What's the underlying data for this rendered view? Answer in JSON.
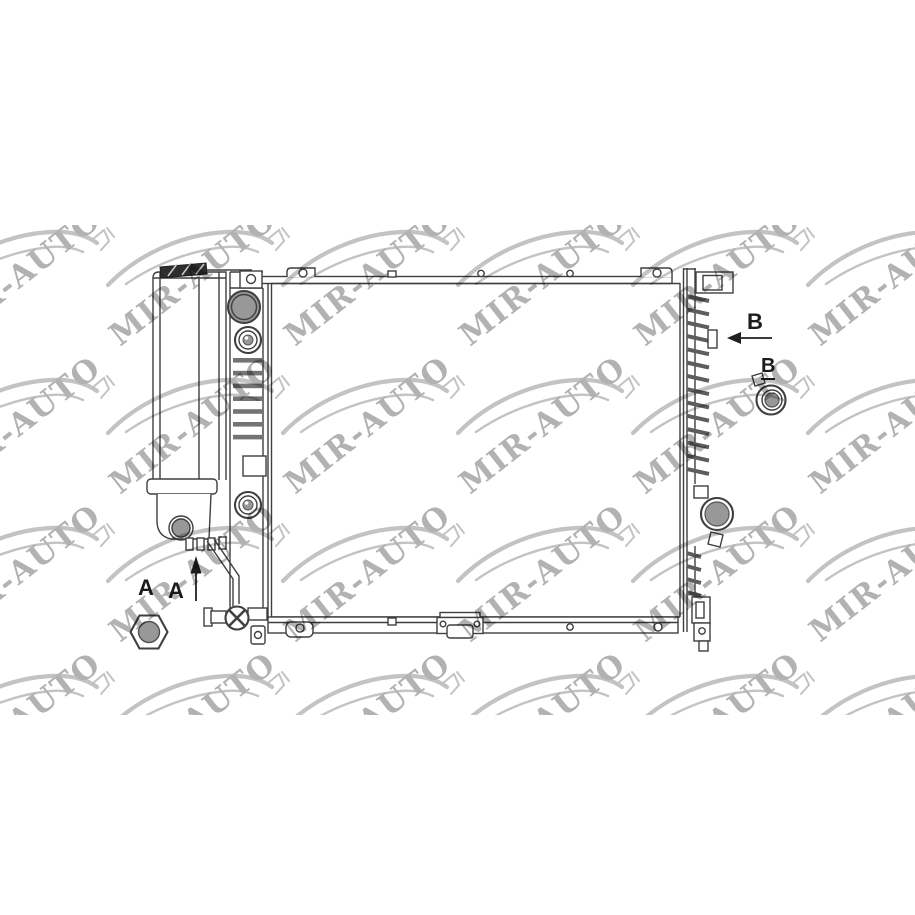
{
  "page": {
    "width": 915,
    "height": 915,
    "background_color": "#ffffff"
  },
  "product_image": {
    "description": "Technical line drawing of an automotive radiator, front view, with left expansion tank, filler cap, drain valves, core, side channel with hose port, mounting grommet, hex nut and phillips screw",
    "style": {
      "line_color": "#3f3f3f",
      "metal_fill": "#989898",
      "dark_fill": "#2e2e2e"
    }
  },
  "watermark": {
    "text": "MIR-AUTO",
    "text_color": "#b2b2b2",
    "swoosh_color": "#c3c3c3",
    "rotation_deg": -38,
    "region": {
      "left": 0,
      "top": 225,
      "width": 915,
      "height": 490
    },
    "tile": {
      "width": 175,
      "height": 148
    },
    "grid": {
      "columns": 6,
      "rows": 4,
      "origin_x": -57,
      "origin_y": 2
    }
  },
  "diagram": {
    "callouts": [
      {
        "id": "A1",
        "text": "A"
      },
      {
        "id": "A2",
        "text": "A"
      },
      {
        "id": "B1",
        "text": "B"
      },
      {
        "id": "B2",
        "text": "B"
      }
    ]
  }
}
